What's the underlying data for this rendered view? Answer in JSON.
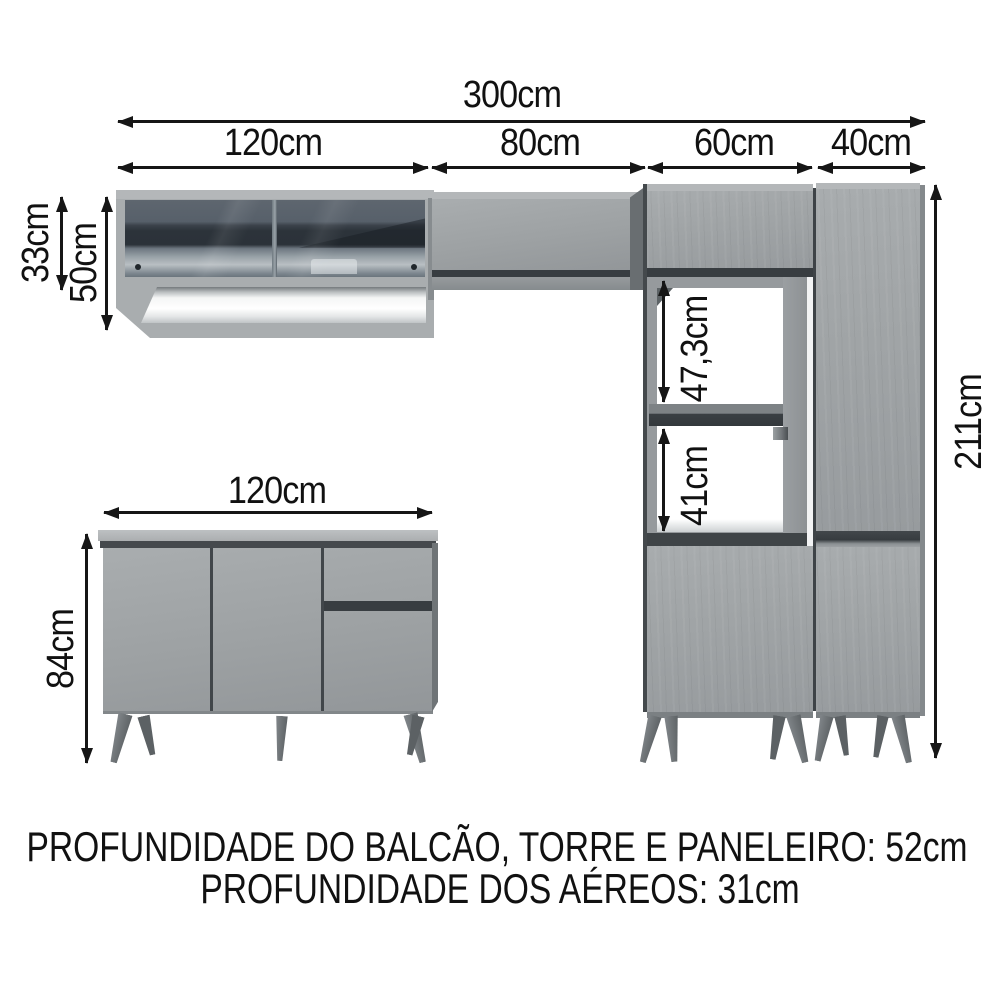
{
  "diagram": {
    "dims": {
      "total_width": "300cm",
      "aereo_left_width": "120cm",
      "aereo_right_width": "80cm",
      "tower_width": "60cm",
      "paneleiro_width": "40cm",
      "aereo_door_height": "33cm",
      "aereo_total_height": "50cm",
      "upper_niche_height": "47,3cm",
      "lower_niche_height": "41cm",
      "total_height": "211cm",
      "balcao_width": "120cm",
      "balcao_height": "84cm"
    },
    "footer": {
      "line1": "PROFUNDIDADE DO BALCÃO, TORRE E PANELEIRO: 52cm",
      "line2": "PROFUNDIDADE DOS AÉREOS: 31cm"
    },
    "colors": {
      "background": "#ffffff",
      "text": "#111111",
      "arrow": "#161616",
      "cabinet_gray": "#a1a5a7",
      "cabinet_light": "#b5b8ba",
      "edge_dark": "#3c4145",
      "glass_dark": "#2e353c",
      "glass_mid": "#59616a",
      "niche_white": "#ffffff",
      "leg_gray": "#6d7275"
    }
  }
}
